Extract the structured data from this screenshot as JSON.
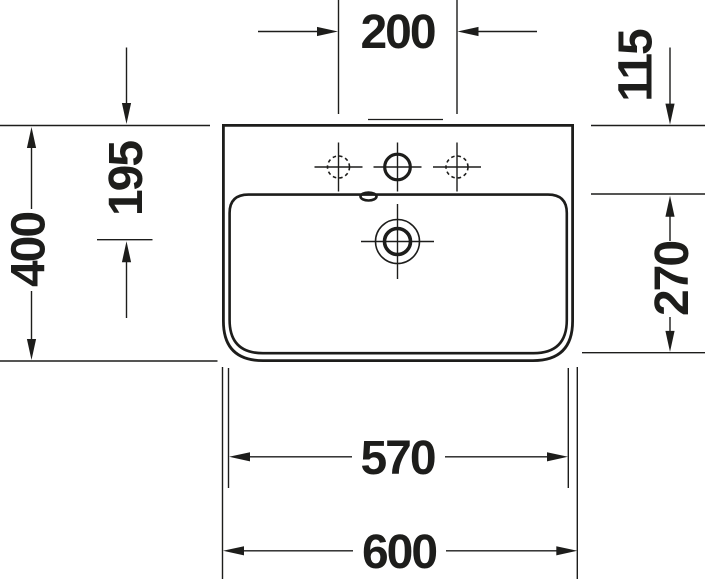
{
  "drawing": {
    "name": "washbasin-technical-drawing",
    "view": "top-view",
    "features": [
      "tap-hole-left-dashed",
      "tap-hole-center",
      "tap-hole-right-dashed",
      "overflow-slot",
      "drain-outlet"
    ]
  },
  "colors": {
    "ink": "#1d1d1b",
    "paper": "#ffffff"
  },
  "dimensions": {
    "tap_hole_spacing": "200",
    "rim_to_inner_basin": "115",
    "rim_to_drain_center": "195",
    "overall_depth": "400",
    "inner_basin_depth": "270",
    "inner_width": "570",
    "overall_width": "600"
  }
}
